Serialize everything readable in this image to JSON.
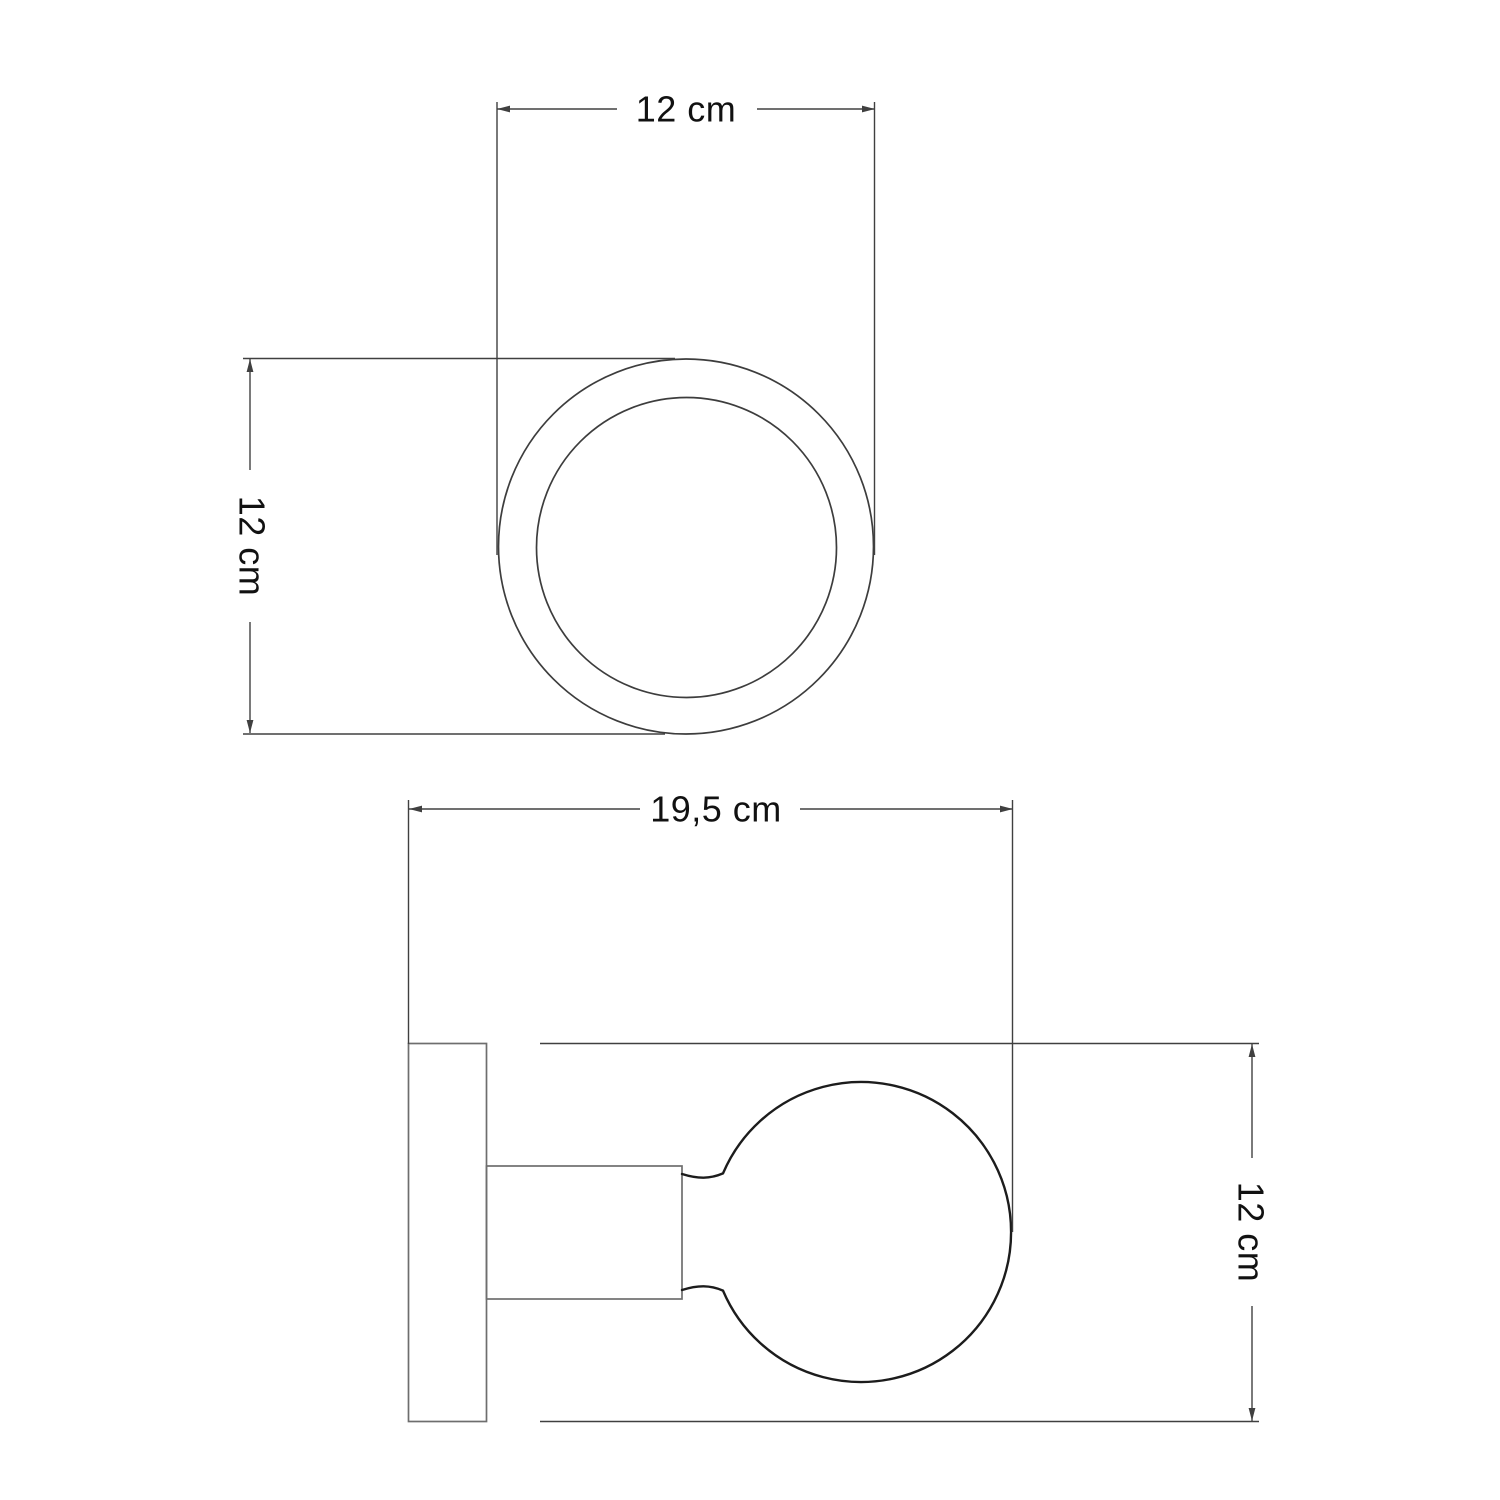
{
  "colors": {
    "background": "#ffffff",
    "dimension_line": "#404040",
    "top_view_outline": "#3d3d3d",
    "fixture_outline": "#6e6e6e",
    "bulb_outline": "#1c1c1c",
    "text": "#111111"
  },
  "top_view": {
    "width_dimension_label": "12 cm",
    "height_dimension_label": "12 cm"
  },
  "side_view": {
    "width_dimension_label": "19,5 cm",
    "height_dimension_label": "12 cm"
  }
}
